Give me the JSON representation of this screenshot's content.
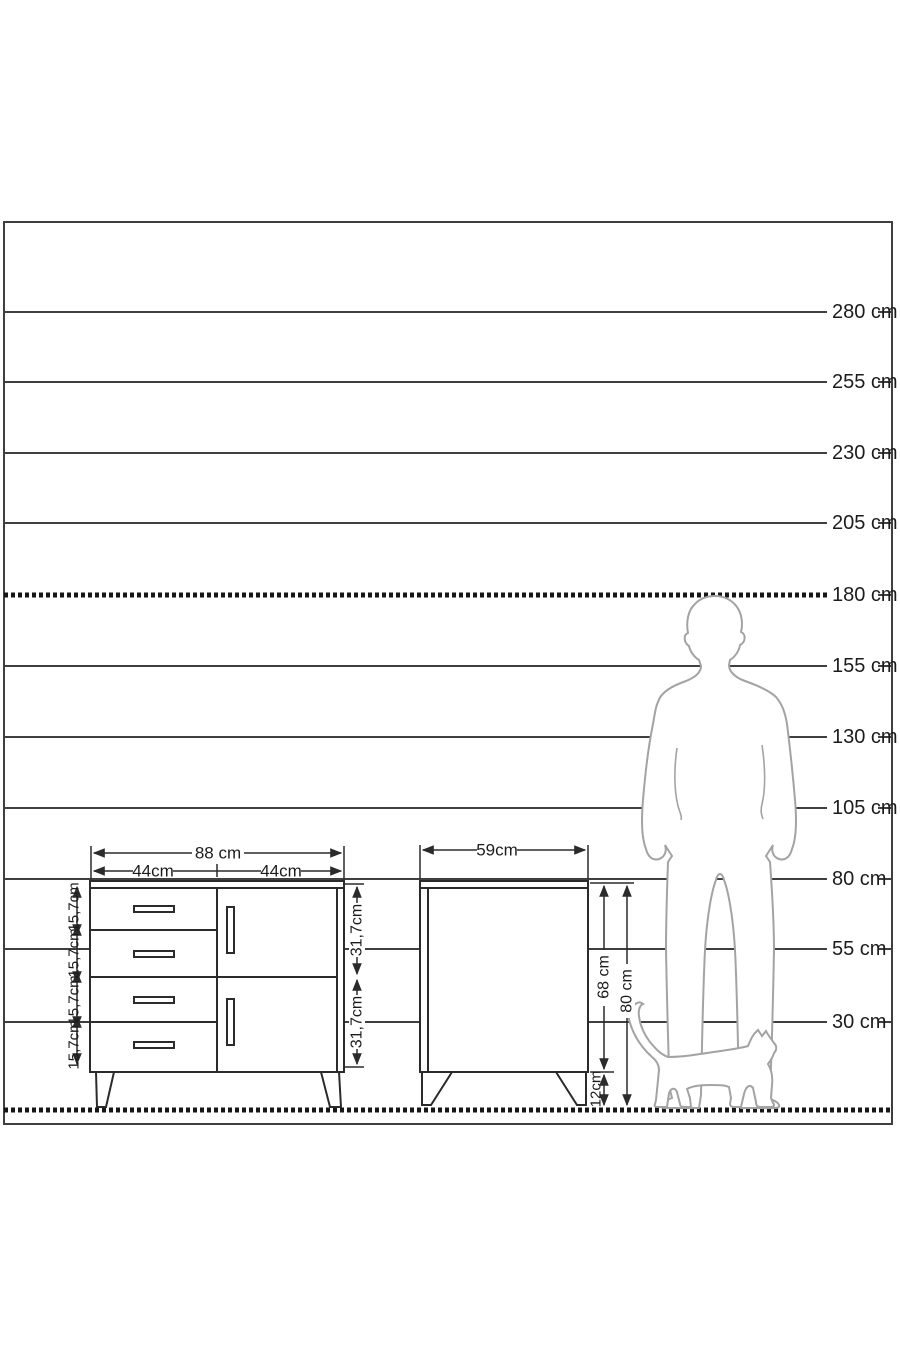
{
  "diagram_title": "furniture-height-scale-diagram",
  "colors": {
    "line": "#3f3f3f",
    "furniture_line": "#2b2b2b",
    "silhouette": "#a3a3a3",
    "text": "#1c1c1c"
  },
  "scale": {
    "labels": [
      "280 cm",
      "255 cm",
      "230 cm",
      "205 cm",
      "180 cm",
      "155 cm",
      "130 cm",
      "105 cm",
      "80 cm",
      "55 cm",
      "30 cm"
    ]
  },
  "sideboard": {
    "width_label": "88 cm",
    "half_width_labels": [
      "44cm",
      "44cm"
    ],
    "drawer_height_labels": [
      "15,7cm",
      "15,7cm",
      "15,7cm",
      "15,7cm"
    ],
    "door_height_labels": [
      "31,7cm",
      "31,7cm"
    ]
  },
  "nightstand": {
    "width_label": "59cm",
    "body_height_label": "68 cm",
    "total_height_label": "80 cm",
    "leg_height_label": "12cm"
  }
}
